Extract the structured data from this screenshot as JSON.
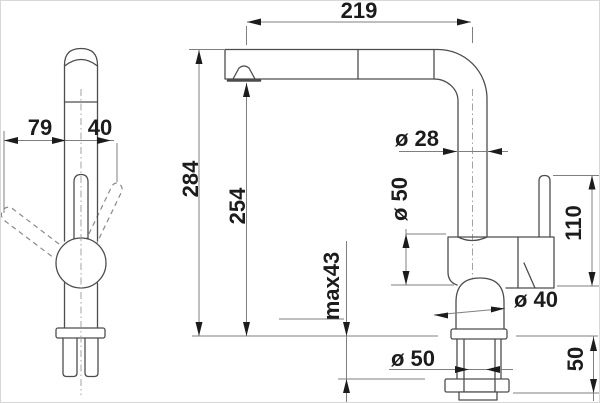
{
  "page": {
    "background": "#ffffff",
    "outline_color": "#4d4d4d",
    "dimension_line_color": "#7f7f7f",
    "text_color": "#1c1c1c"
  },
  "dimensions": {
    "spout_reach": "219",
    "side_offset_left": "79",
    "side_offset_right": "40",
    "total_height": "284",
    "outlet_height": "254",
    "pipe_diameter": "ø 28",
    "body_diameter": "ø 50",
    "handle_height": "110",
    "max_counter_thickness": "max43",
    "base_diameter": "ø 40",
    "base_ring_diameter": "ø 50",
    "shank_length": "50"
  }
}
